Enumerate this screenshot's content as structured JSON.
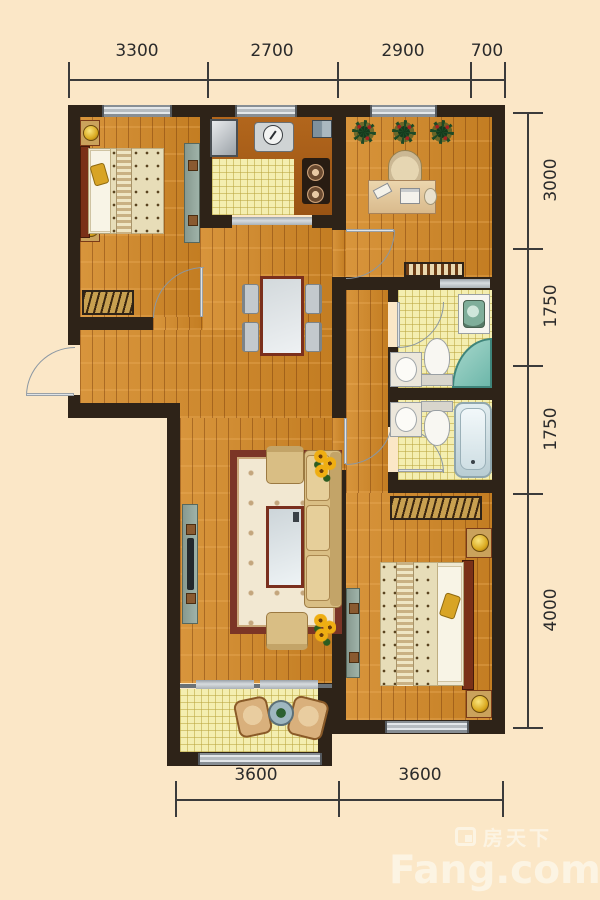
{
  "watermark": {
    "brand_cn": "房天下",
    "brand_en": "Fang.com"
  },
  "dimensions": {
    "top": [
      {
        "label": "3300"
      },
      {
        "label": "2700"
      },
      {
        "label": "2900"
      },
      {
        "label": "700"
      }
    ],
    "right": [
      {
        "label": "3000"
      },
      {
        "label": "1750"
      },
      {
        "label": "1750"
      },
      {
        "label": "4000"
      }
    ],
    "bottom": [
      {
        "label": "3600"
      },
      {
        "label": "3600"
      }
    ]
  },
  "colors": {
    "background": "#fbe7c7",
    "wall": "#2e2318",
    "wood_floor": "#cf8a2e",
    "tile_floor": "#f4eeb0",
    "kitchen_counter": "#a85e18",
    "window_gray": "#b6bcc1",
    "shower_glass": "#7cc4b8",
    "dimension_text": "#2b2b2b",
    "watermark_text": "#fdf5e6"
  }
}
